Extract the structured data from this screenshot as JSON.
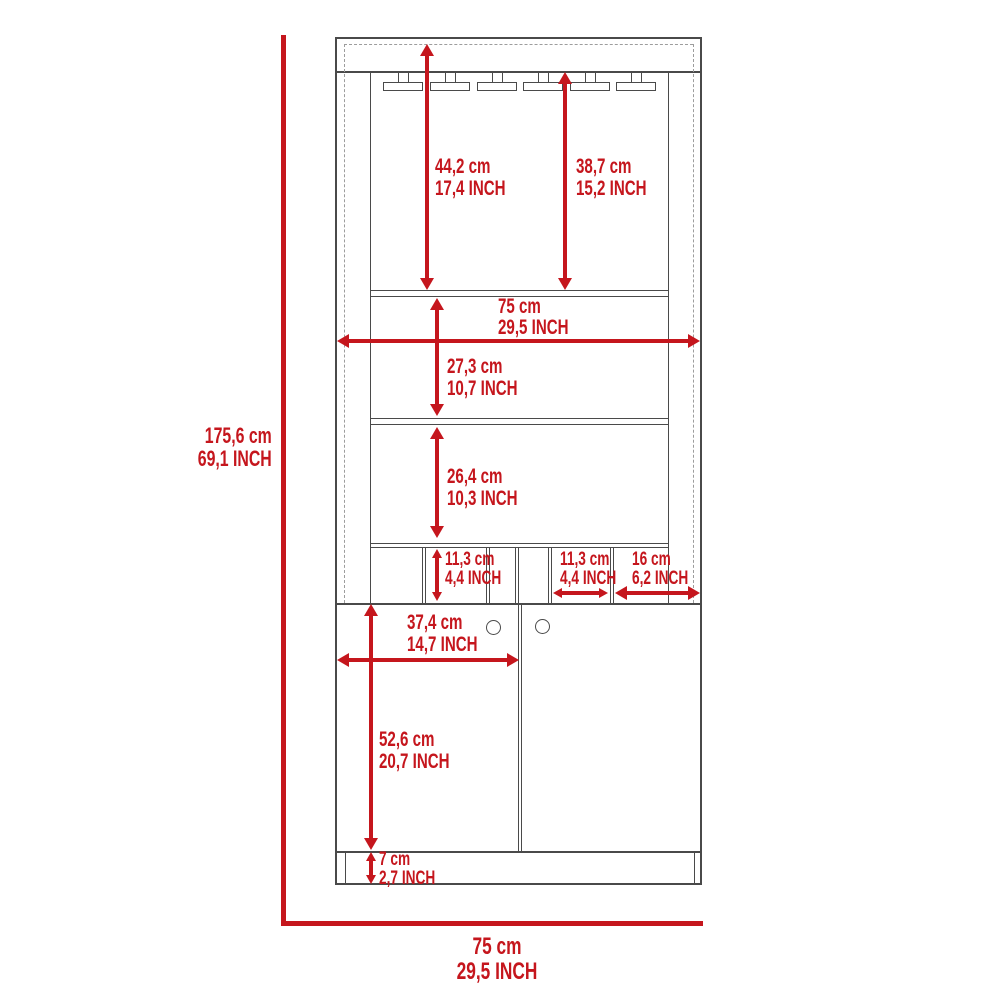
{
  "diagram": {
    "kind": "furniture dimension drawing",
    "subject": "bar cabinet with stemware racks, shelves, wine cubbies and two-door base",
    "colors": {
      "dimension_red": "#c5161d",
      "line_gray": "#4a4a4a",
      "dashed_gray": "#9d9d9d"
    },
    "dimensions": {
      "overall_height": {
        "cm": "175,6 cm",
        "inch": "69,1 INCH"
      },
      "overall_width_bottom": {
        "cm": "75 cm",
        "inch": "29,5 INCH"
      },
      "interior_width": {
        "cm": "75 cm",
        "inch": "29,5 INCH"
      },
      "top_section_with_panel": {
        "cm": "44,2 cm",
        "inch": "17,4 INCH"
      },
      "top_section_clearance": {
        "cm": "38,7 cm",
        "inch": "15,2 INCH"
      },
      "middle_section_height": {
        "cm": "27,3 cm",
        "inch": "10,7 INCH"
      },
      "open_shelf_height": {
        "cm": "26,4 cm",
        "inch": "10,3 INCH"
      },
      "cubby_height": {
        "cm": "11,3 cm",
        "inch": "4,4 INCH"
      },
      "cubby_width": {
        "cm": "11,3 cm",
        "inch": "4,4 INCH"
      },
      "side_compartment_width": {
        "cm": "16 cm",
        "inch": "6,2 INCH"
      },
      "door_width": {
        "cm": "37,4 cm",
        "inch": "14,7 INCH"
      },
      "door_height": {
        "cm": "52,6 cm",
        "inch": "20,7 INCH"
      },
      "base_height": {
        "cm": "7 cm",
        "inch": "2,7 INCH"
      }
    }
  }
}
